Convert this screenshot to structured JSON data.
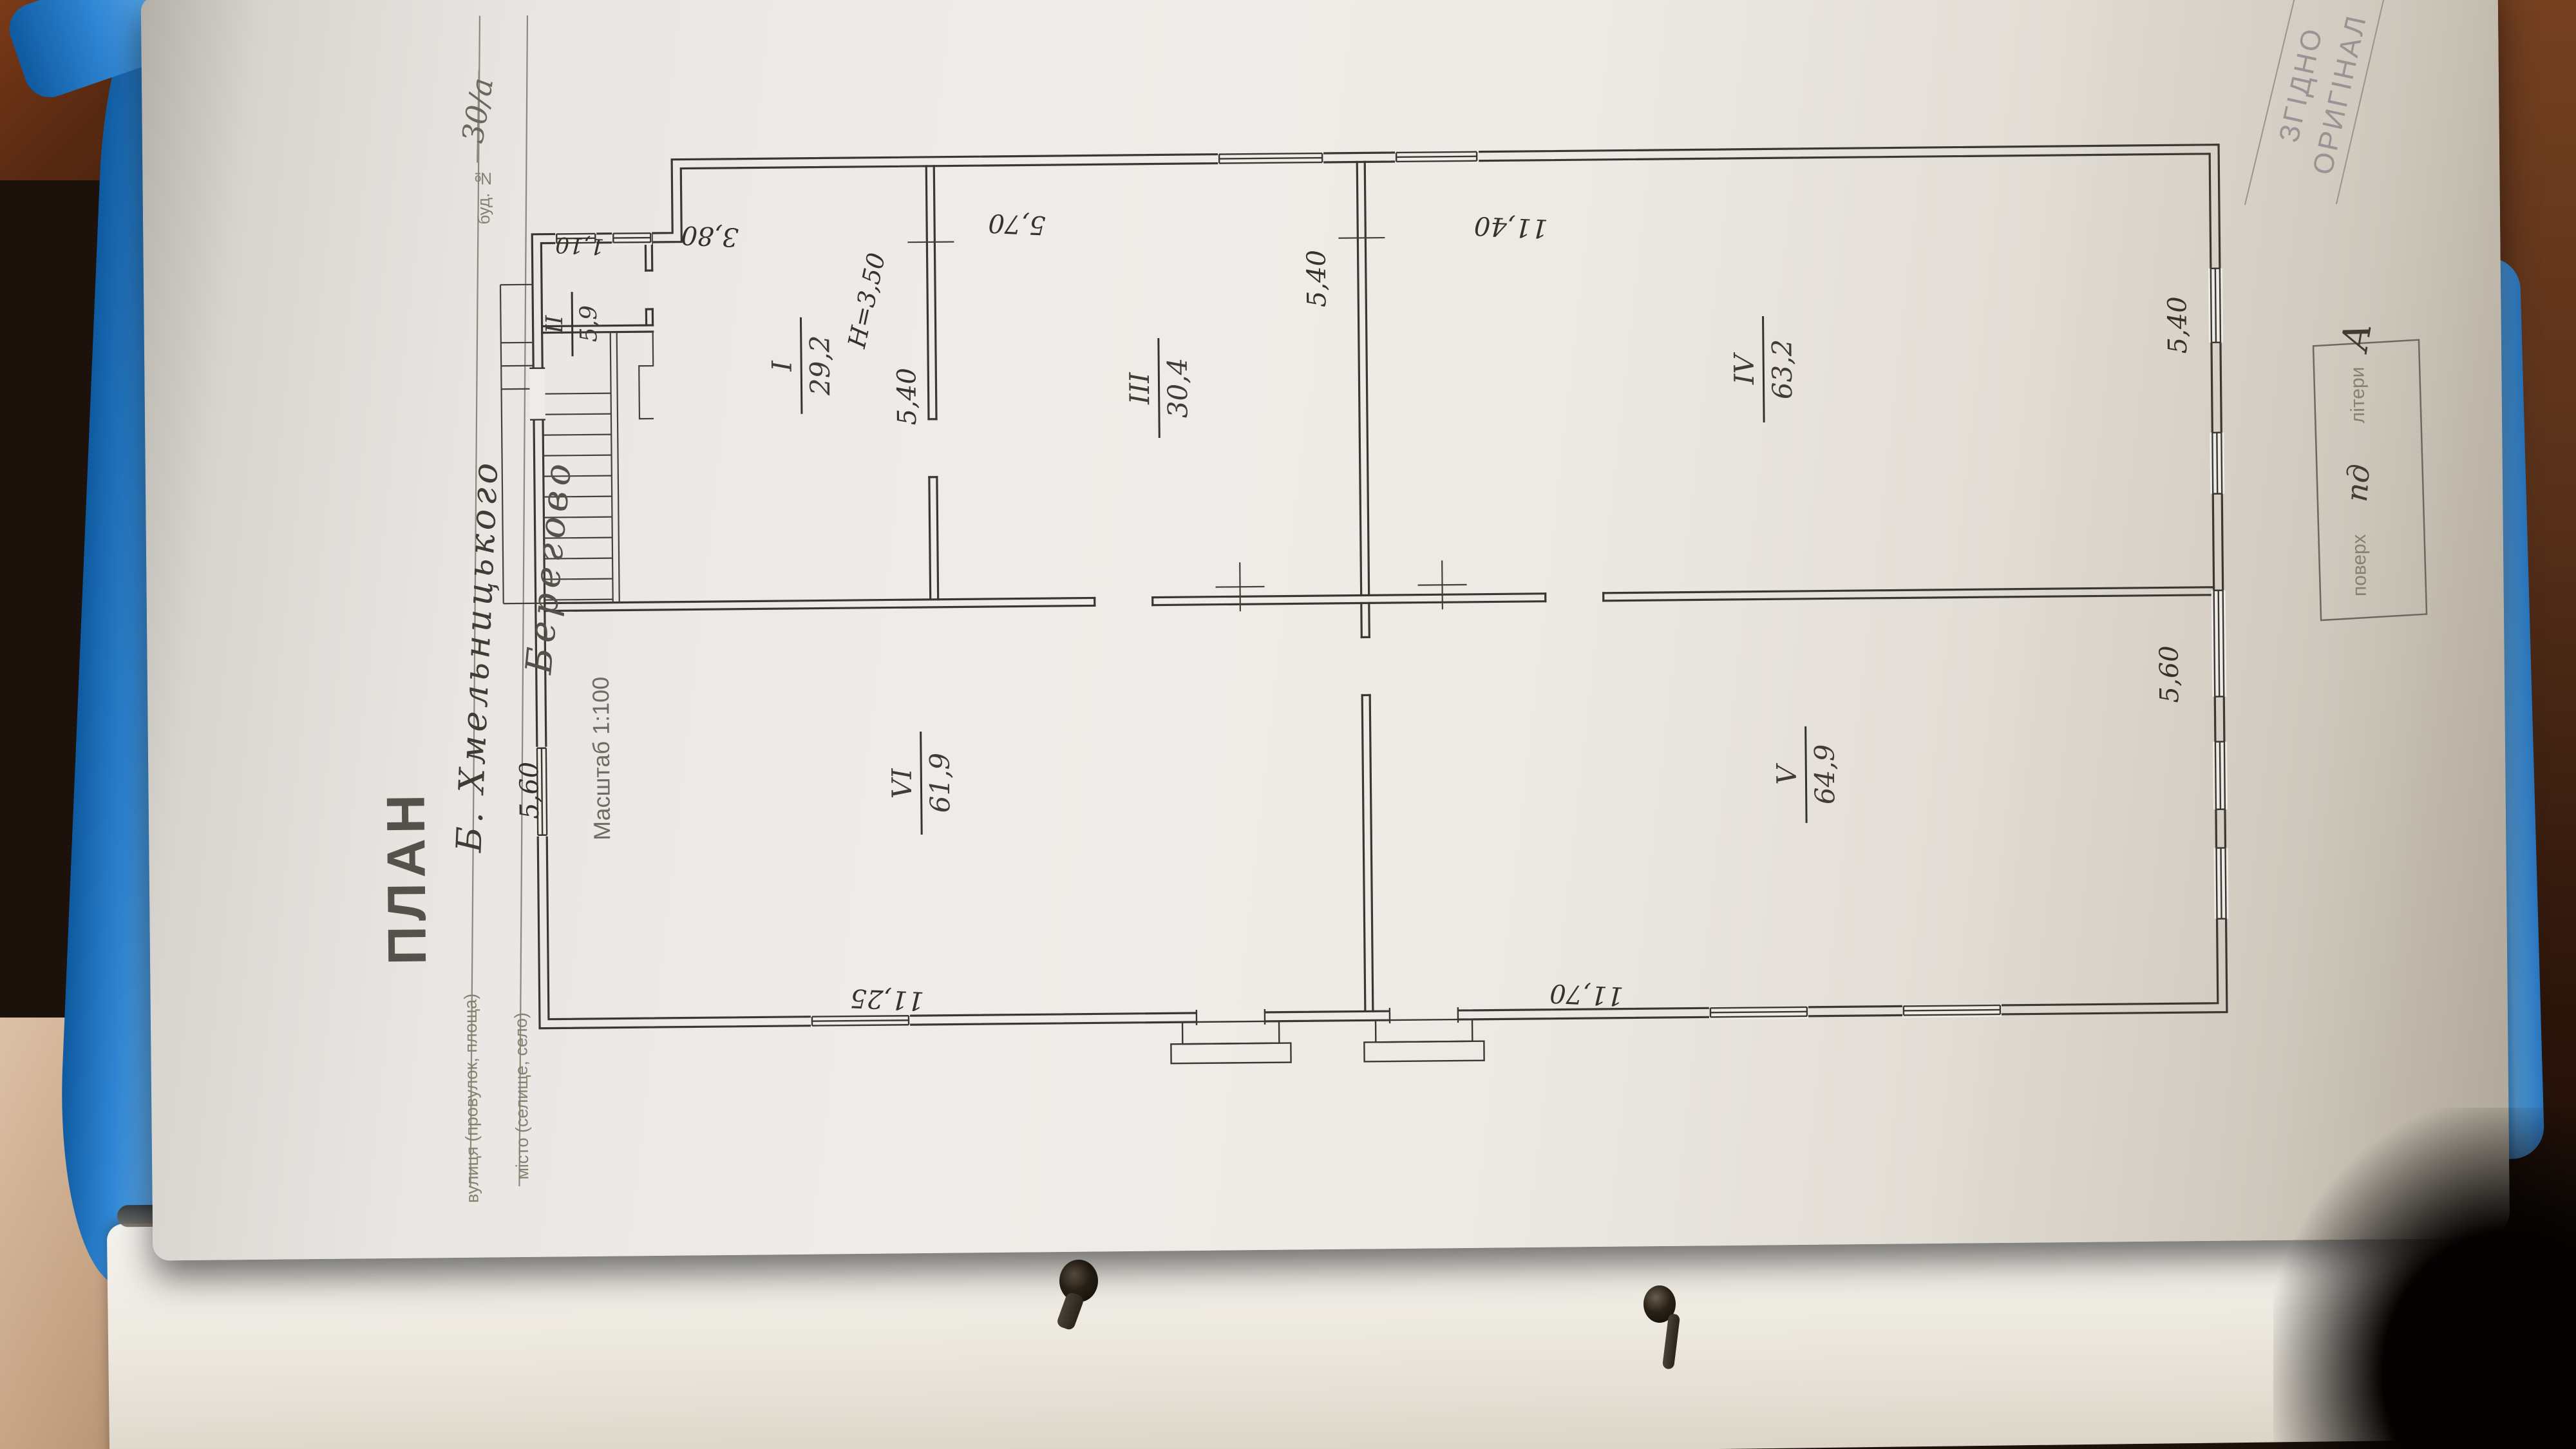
{
  "colors": {
    "folder_blue": "#2f86d4",
    "desk_wood": "#6e3c1d",
    "paper": "#efede9",
    "ink": "#3c3934"
  },
  "title_block": {
    "title": "ПЛАН",
    "scale": "Масштаб 1:100",
    "building_label": "буд. №",
    "building_value": "30/а",
    "street_label": "вулиця (провулок, площа)",
    "street_value": "Б. Хмельницького",
    "city_label": "місто (селище, село)",
    "city_value": "Берегово"
  },
  "stamp": {
    "line1": "ЗГІДНО",
    "line2": "ОРИГІНАЛ"
  },
  "floor_box": {
    "floor_label": "поверх",
    "floor_value": "пд",
    "letter_label": "літери",
    "letter_value": "А"
  },
  "plan": {
    "height_note": "H=3,50",
    "rooms": [
      {
        "numeral": "I",
        "area": "29,2"
      },
      {
        "numeral": "II",
        "area": "5,9"
      },
      {
        "numeral": "III",
        "area": "30,4"
      },
      {
        "numeral": "IV",
        "area": "63,2"
      },
      {
        "numeral": "V",
        "area": "64,9"
      },
      {
        "numeral": "VI",
        "area": "61,9"
      }
    ],
    "dims": {
      "niche": "1,10",
      "top_room1": "3,80",
      "top_room3": "5,70",
      "top_room4": "11,40",
      "inner_room1": "5,40",
      "inner_room3": "5,40",
      "right_upper": "5,40",
      "right_lower": "5,60",
      "left_lower": "5,60",
      "bottom_left": "11,25",
      "bottom_right": "11,70"
    }
  }
}
